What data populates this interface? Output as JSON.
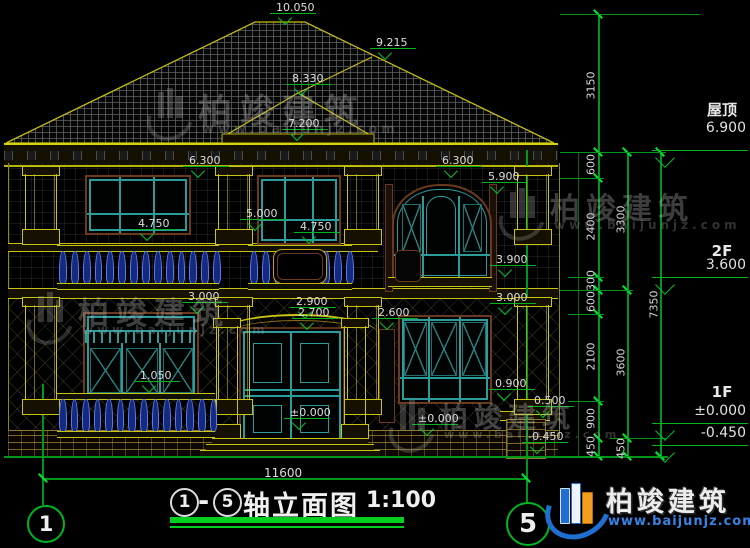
{
  "drawing_title": {
    "axis_from": "1",
    "dash": "-",
    "axis_to": "5",
    "name": "轴立面图",
    "scale": "1:100"
  },
  "axes": {
    "left_bubble": "1",
    "right_bubble": "5"
  },
  "bottom_dimension": {
    "value": "11600"
  },
  "levels": [
    {
      "name": "屋顶",
      "value": "6.900",
      "ny": 99,
      "vy": 120,
      "ly": 150
    },
    {
      "name": "2F",
      "value": "3.600",
      "ny": 242,
      "vy": 257,
      "ly": 277
    },
    {
      "name": "1F",
      "value": "±0.000",
      "ny": 383,
      "vy": 403,
      "ly": 423
    },
    {
      "name": "",
      "value": "-0.450",
      "ny": -99,
      "vy": 425,
      "ly": 445
    }
  ],
  "elevation_marks": [
    {
      "v": "10.050",
      "x": 276,
      "y": 1
    },
    {
      "v": "9.215",
      "x": 376,
      "y": 36
    },
    {
      "v": "8.330",
      "x": 292,
      "y": 72
    },
    {
      "v": "7.200",
      "x": 288,
      "y": 117
    },
    {
      "v": "6.300",
      "x": 189,
      "y": 154
    },
    {
      "v": "6.300",
      "x": 442,
      "y": 154
    },
    {
      "v": "5.900",
      "x": 488,
      "y": 170
    },
    {
      "v": "4.750",
      "x": 138,
      "y": 217
    },
    {
      "v": "5.000",
      "x": 246,
      "y": 207
    },
    {
      "v": "4.750",
      "x": 300,
      "y": 220
    },
    {
      "v": "3.900",
      "x": 496,
      "y": 253
    },
    {
      "v": "3.000",
      "x": 188,
      "y": 290
    },
    {
      "v": "2.900",
      "x": 296,
      "y": 295
    },
    {
      "v": "2.700",
      "x": 298,
      "y": 306
    },
    {
      "v": "2.600",
      "x": 378,
      "y": 306
    },
    {
      "v": "3.000",
      "x": 496,
      "y": 291
    },
    {
      "v": "1.050",
      "x": 140,
      "y": 369
    },
    {
      "v": "0.900",
      "x": 495,
      "y": 377
    },
    {
      "v": "0.500",
      "x": 534,
      "y": 394
    },
    {
      "v": "±0.000",
      "x": 290,
      "y": 406
    },
    {
      "v": "±0.000",
      "x": 418,
      "y": 412
    },
    {
      "v": "-0.450",
      "x": 528,
      "y": 430
    }
  ],
  "chain_dimensions": [
    {
      "v": "3150",
      "x": 591,
      "y": 86
    },
    {
      "v": "600",
      "x": 591,
      "y": 165
    },
    {
      "v": "2400",
      "x": 591,
      "y": 227
    },
    {
      "v": "300",
      "x": 591,
      "y": 281
    },
    {
      "v": "600",
      "x": 591,
      "y": 302
    },
    {
      "v": "2100",
      "x": 591,
      "y": 357
    },
    {
      "v": "900",
      "x": 591,
      "y": 419
    },
    {
      "v": "450",
      "x": 591,
      "y": 447
    },
    {
      "v": "3300",
      "x": 621,
      "y": 220
    },
    {
      "v": "3600",
      "x": 621,
      "y": 363
    },
    {
      "v": "450",
      "x": 621,
      "y": 449
    },
    {
      "v": "7350",
      "x": 654,
      "y": 305
    }
  ],
  "watermark": {
    "brand": "柏竣建筑",
    "url": "www.baijunjz.com"
  },
  "brand_logo": {
    "brand": "柏竣建筑",
    "url": "www.baijunjz.com"
  },
  "colors": {
    "dim_green": "#00b41e",
    "outline_yellow": "#c8c414",
    "window_teal": "#2e9b9b",
    "trim_brown": "#6b3a1e",
    "baluster_blue": "#5b7cf0",
    "logo_blue": "#1e6fd0",
    "logo_orange": "#f59d1e"
  }
}
